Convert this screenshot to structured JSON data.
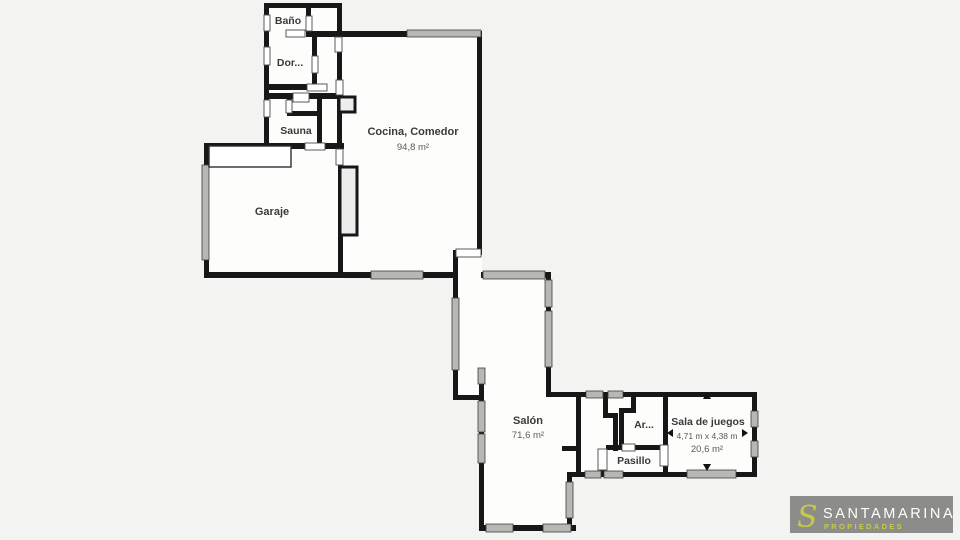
{
  "floorplan": {
    "type": "residential floor plan",
    "rooms": [
      {
        "id": "bano",
        "label": "Baño"
      },
      {
        "id": "dormitorio",
        "label": "Dor..."
      },
      {
        "id": "sauna",
        "label": "Sauna"
      },
      {
        "id": "cocina-comedor",
        "label": "Cocina, Comedor",
        "area": "94,8 m²"
      },
      {
        "id": "garaje",
        "label": "Garaje"
      },
      {
        "id": "salon",
        "label": "Salón",
        "area": "71,6 m²"
      },
      {
        "id": "armario",
        "label": "Ar..."
      },
      {
        "id": "pasillo",
        "label": "Pasillo"
      },
      {
        "id": "sala-de-juegos",
        "label": "Sala de juegos",
        "dimensions": "4,71 m x 4,38 m",
        "area": "20,6 m²"
      }
    ]
  },
  "branding": {
    "monogram": "S",
    "name": "SANTAMARINA",
    "tagline": "PROPIEDADES"
  },
  "colors": {
    "background": "#f3f3f1",
    "room_fill": "#fdfdfc",
    "wall": "#171717",
    "window_fill": "#b7b7b4",
    "logo_background": "#8c8c8a",
    "logo_text": "#ffffff",
    "logo_accent": "#c5cb47"
  }
}
